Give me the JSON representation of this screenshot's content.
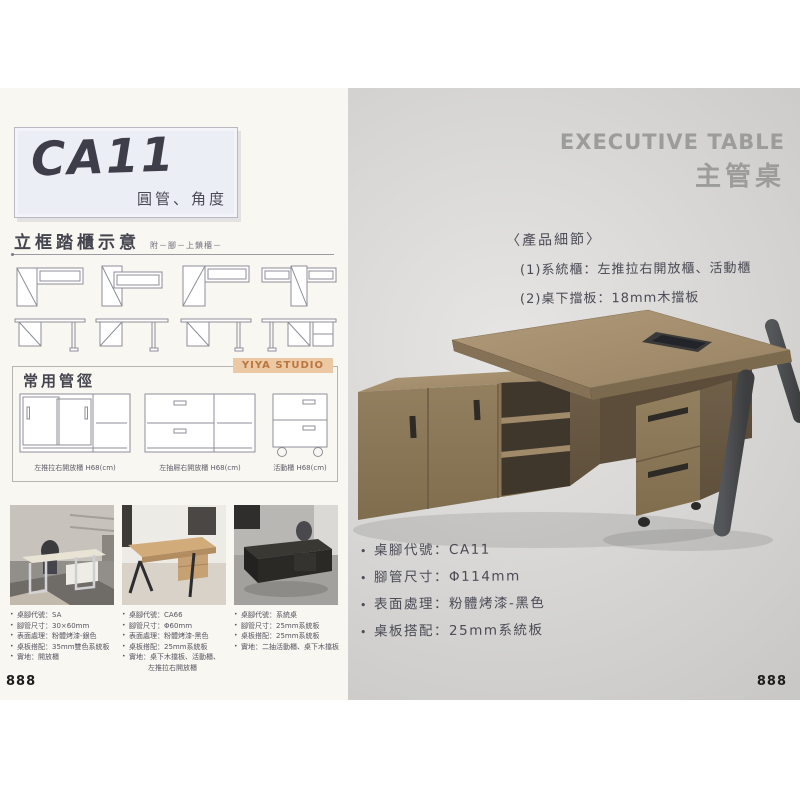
{
  "page": {
    "left_page_number": "888",
    "right_page_number": "888"
  },
  "left": {
    "title_box": {
      "code": "CA11",
      "subtitle": "圓管、角度"
    },
    "frames_section": {
      "heading": "立框踏櫃示意",
      "note": "附－腳－上鎖櫃－"
    },
    "pipes_section": {
      "heading": "常用管徑",
      "badge": "YIYA STUDIO",
      "cabinets": [
        {
          "caption": "左推拉右開放櫃 H68(cm)"
        },
        {
          "caption": "左抽屜右開放櫃 H68(cm)"
        },
        {
          "caption": "活動櫃 H68(cm)"
        }
      ]
    },
    "photo_specs": [
      {
        "lines": [
          "桌腳代號：SA",
          "腳管尺寸：30×60mm",
          "表面處理：粉體烤漆-銀色",
          "桌板搭配：35mm雙色系統板",
          "實地：開放櫃"
        ]
      },
      {
        "lines": [
          "桌腳代號：CA66",
          "腳管尺寸：Φ60mm",
          "表面處理：粉體烤漆-黑色",
          "桌板搭配：25mm系統板",
          "實地：桌下木擋板、活動櫃、",
          "左推拉右開放櫃"
        ]
      },
      {
        "lines": [
          "桌腳代號：系統桌",
          "腳管尺寸：25mm系統板",
          "桌板搭配：25mm系統板",
          "實地：二抽活動櫃、桌下木擋板"
        ]
      }
    ]
  },
  "right": {
    "title_en": "EXECUTIVE TABLE",
    "title_zh": "主管桌",
    "details_heading": "〈產品細節〉",
    "details": [
      "(1)系統櫃：左推拉右開放櫃、活動櫃",
      "(2)桌下擋板：18mm木擋板"
    ],
    "bullets": [
      "桌腳代號：CA11",
      "腳管尺寸：Φ114mm",
      "表面處理：粉體烤漆-黑色",
      "桌板搭配：25mm系統板"
    ]
  },
  "colors": {
    "left_bg": "#f9f7f1",
    "right_bg": "#d6d5d3",
    "badge_bg": "#ecc9a4",
    "badge_text": "#b9763f",
    "title_gray": "#9c9c9a",
    "ink": "#4b4b56",
    "wood_top": "#a89372",
    "wood_front": "#8d795c",
    "wood_side": "#6e5c45",
    "leg_gray": "#46484a"
  }
}
